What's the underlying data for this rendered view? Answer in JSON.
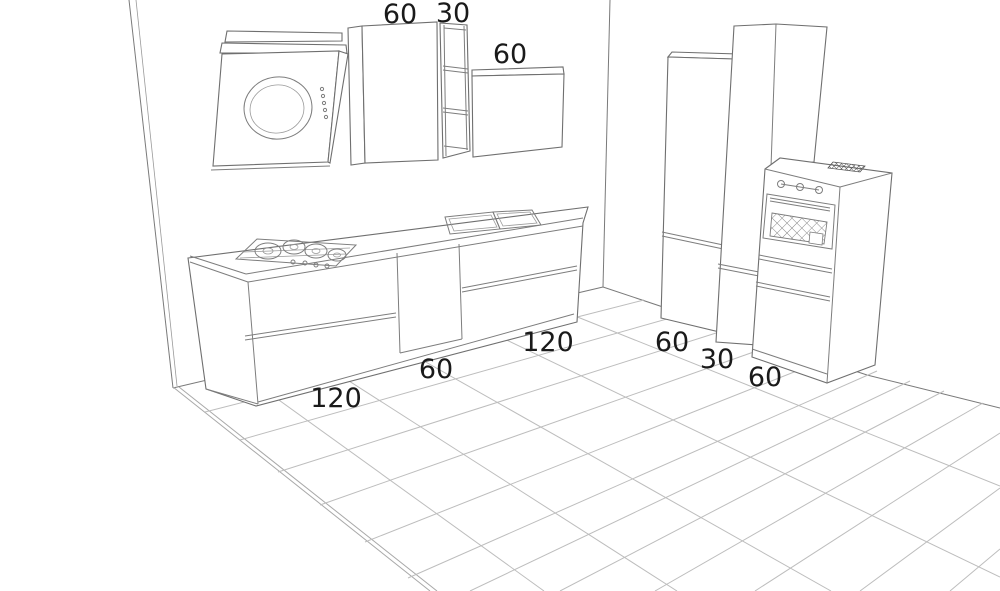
{
  "scene": {
    "kind": "kitchen-3d-line-render",
    "floor_pattern": "diagonal-tile-grid"
  },
  "colors": {
    "background": "#ffffff",
    "outline": "#6f6f6f",
    "floor_grid": "#bdbdbd",
    "label": "#1a1a1a",
    "vent_fill": "#8f8f8f"
  },
  "dimensions": [
    {
      "object": "wall-cabinet-tall",
      "text": "60"
    },
    {
      "object": "open-shelf-unit",
      "text": "30"
    },
    {
      "object": "wall-cabinet-low",
      "text": "60"
    },
    {
      "object": "base-cabinet-hob",
      "text": "120"
    },
    {
      "object": "base-cabinet-middle",
      "text": "60"
    },
    {
      "object": "base-cabinet-sink",
      "text": "120"
    },
    {
      "object": "tall-cabinet",
      "text": "60"
    },
    {
      "object": "tall-cabinet-narrow",
      "text": "30"
    },
    {
      "object": "oven-tower",
      "text": "60"
    }
  ]
}
